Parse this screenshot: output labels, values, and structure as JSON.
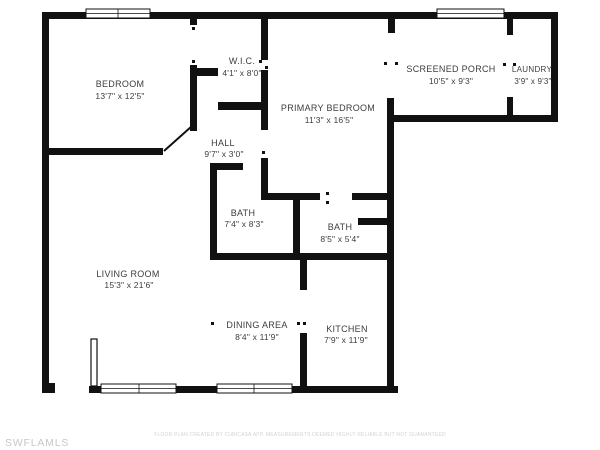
{
  "plan": {
    "wall_color": "#111111",
    "label_color": "#3d3d3d",
    "background": "#ffffff"
  },
  "rooms": [
    {
      "name": "BEDROOM",
      "dims": "13'7\" x 12'5\""
    },
    {
      "name": "W.I.C.",
      "dims": "4'1\" x 8'0\""
    },
    {
      "name": "SCREENED PORCH",
      "dims": "10'5\" x 9'3\""
    },
    {
      "name": "LAUNDRY",
      "dims": "3'9\" x 9'3\""
    },
    {
      "name": "PRIMARY BEDROOM",
      "dims": "11'3\" x 16'5\""
    },
    {
      "name": "HALL",
      "dims": "9'7\" x 3'0\""
    },
    {
      "name": "BATH",
      "dims": "7'4\" x 8'3\""
    },
    {
      "name": "BATH",
      "dims": "8'5\" x 5'4\""
    },
    {
      "name": "LIVING ROOM",
      "dims": "15'3\" x 21'6\""
    },
    {
      "name": "DINING AREA",
      "dims": "8'4\" x 11'9\""
    },
    {
      "name": "KITCHEN",
      "dims": "7'9\" x 11'9\""
    }
  ],
  "footer": {
    "watermark": "SWFLAMLS",
    "disclaimer": "FLOOR PLAN CREATED BY CUBICASA APP. MEASUREMENTS DEEMED HIGHLY RELIABLE BUT NOT GUARANTEED"
  }
}
